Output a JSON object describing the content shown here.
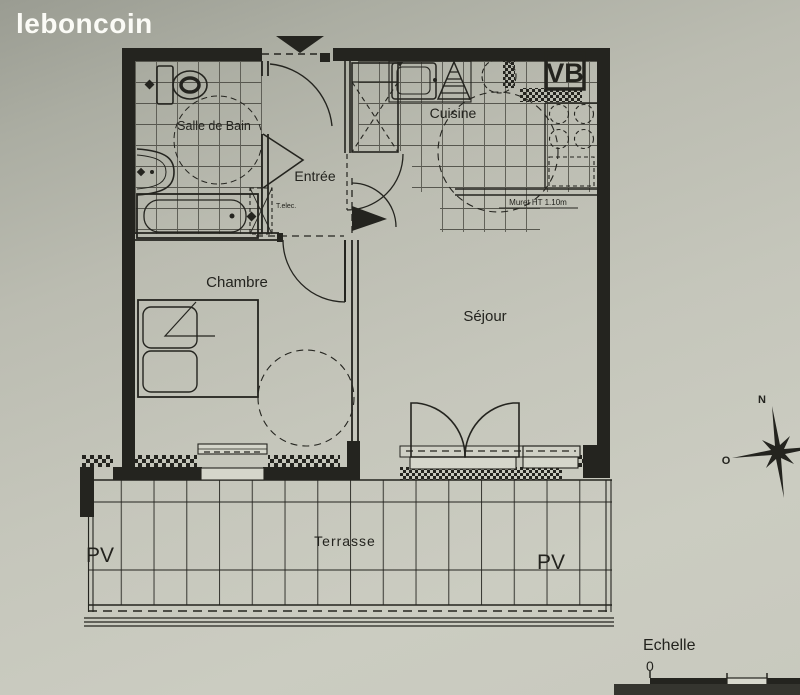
{
  "site": {
    "logo_text": "leboncoin"
  },
  "plan": {
    "rooms": {
      "salle_de_bain": "Salle de Bain",
      "entree": "Entrée",
      "cuisine": "Cuisine",
      "chambre": "Chambre",
      "sejour": "Séjour",
      "terrasse": "Terrasse"
    },
    "labels": {
      "vb": "VB",
      "muret": "Muret HT 1.10m",
      "tableau_elec": "T.elec.",
      "pv_left": "PV",
      "pv_right": "PV"
    },
    "compass": {
      "north": "N",
      "west": "O"
    },
    "scale": {
      "title": "Echelle",
      "zero": "0"
    },
    "colors": {
      "ink": "#24241f",
      "paper": "#c3c4b9",
      "logo": "#fbfbf6"
    }
  }
}
